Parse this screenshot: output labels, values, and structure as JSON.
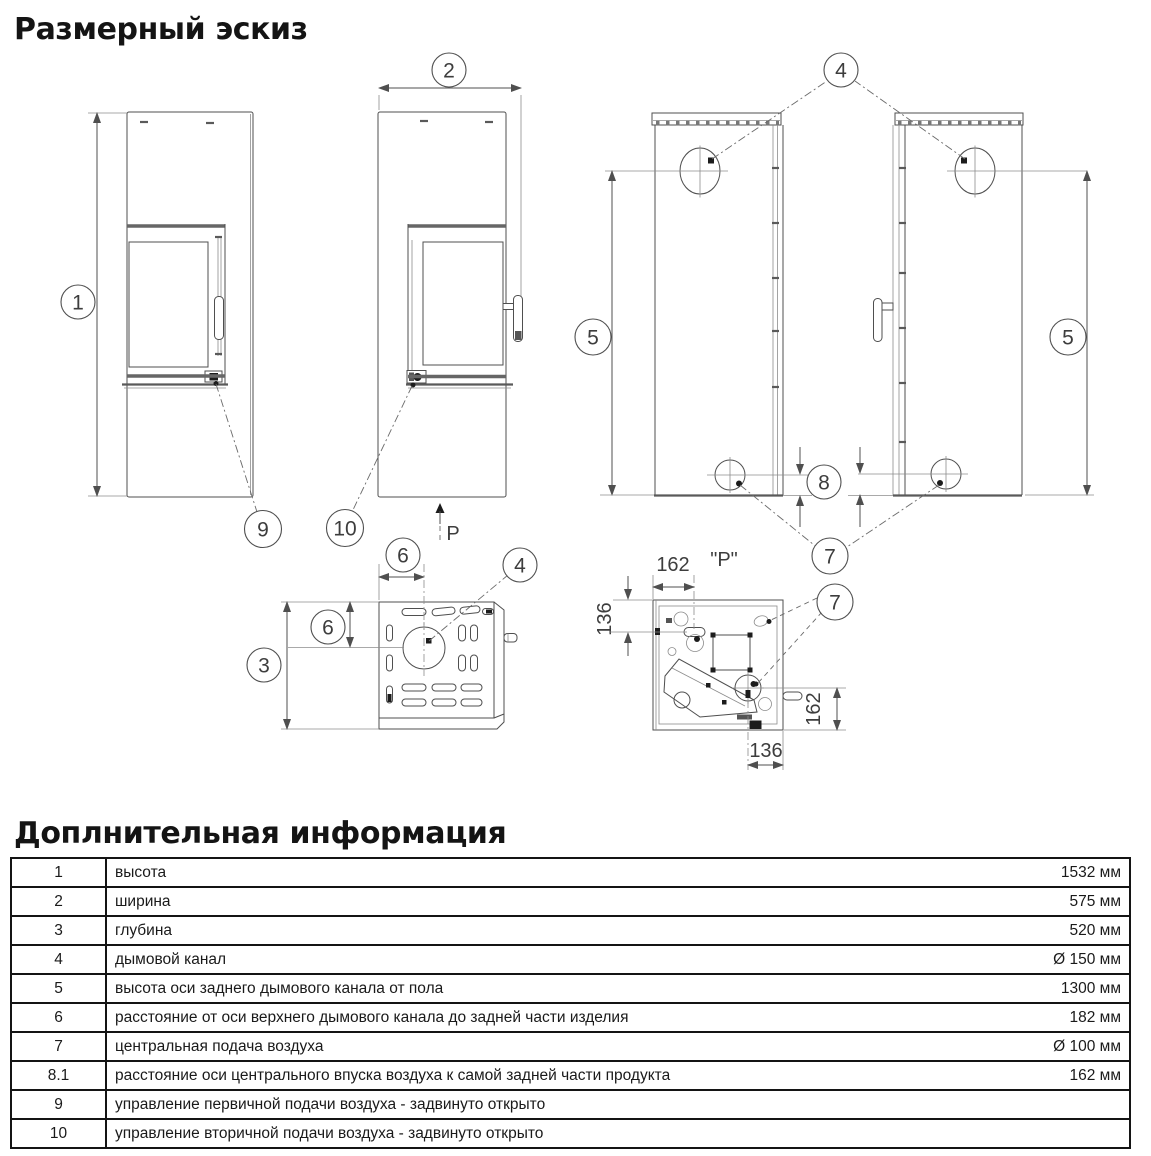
{
  "page": {
    "title": "Размерный эскиз"
  },
  "info": {
    "title": "Доплнительная информация"
  },
  "drawing": {
    "callouts": {
      "c1": "1",
      "c2": "2",
      "c3": "3",
      "c4": "4",
      "c5": "5",
      "c6": "6",
      "c7": "7",
      "c8": "8",
      "c9": "9",
      "c10": "10"
    },
    "dims": {
      "top": "162",
      "left": "136",
      "right": "162",
      "bottom": "136"
    },
    "labels": {
      "view": "\"P\"",
      "direction": "P"
    }
  },
  "table": {
    "rows": [
      {
        "num": "1",
        "desc": "высота",
        "value": "1532 мм"
      },
      {
        "num": "2",
        "desc": "ширина",
        "value": "575 мм"
      },
      {
        "num": "3",
        "desc": "глубина",
        "value": "520 мм"
      },
      {
        "num": "4",
        "desc": "дымовой канал",
        "value": "Ø 150 мм"
      },
      {
        "num": "5",
        "desc": "высота оси заднего дымового канала от пола",
        "value": "1300 мм"
      },
      {
        "num": "6",
        "desc": "расстояние от оси верхнего дымового канала до задней части изделия",
        "value": "182 мм"
      },
      {
        "num": "7",
        "desc": "центральная подача воздуха",
        "value": "Ø 100 мм"
      },
      {
        "num": "8.1",
        "desc": "расстояние оси центрального впуска воздуха к самой задней части продукта",
        "value": "162 мм"
      },
      {
        "num": "9",
        "desc": "управление первичной подачи воздуха - задвинуто открыто",
        "value": ""
      },
      {
        "num": "10",
        "desc": "управление вторичной подачи воздуха - задвинуто открыто",
        "value": ""
      }
    ]
  }
}
